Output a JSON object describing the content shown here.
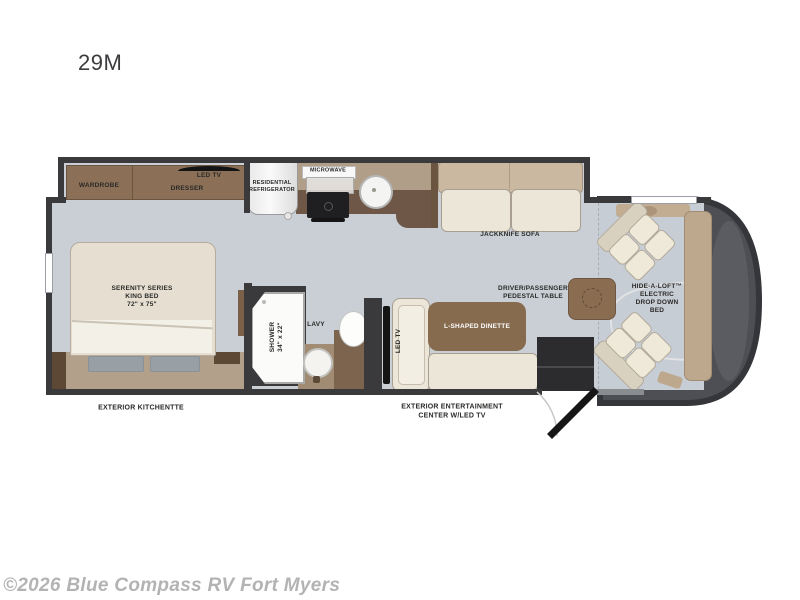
{
  "page": {
    "model": "29M",
    "watermark": "©2026 Blue Compass RV Fort Myers"
  },
  "colors": {
    "floor": "#c9cfd5",
    "wall": "#3a3a3c",
    "cabinet_wood": "#8b7057",
    "counter_dark": "#6e5746",
    "counter_light": "#b19e89",
    "seat_cream": "#ece6d8",
    "sofa_back_tan": "#cbb8a1",
    "cab_nose_gray": "#4e4f54",
    "bed_platform_tan": "#b2a08b"
  },
  "labels": {
    "wardrobe": "WARDROBE",
    "bedroom_tv": "LED TV",
    "dresser": "DRESSER",
    "refrigerator": "RESIDENTIAL\nREFRIGERATOR",
    "microwave": "MICROWAVE",
    "jackknife_sofa": "JACKKNIFE SOFA",
    "king_bed": "SERENITY SERIES\nKING BED\n72\" x 75\"",
    "shower": "SHOWER\n34\" x 22\"",
    "lavy": "LAVY",
    "dinette_tv": "LED TV",
    "dinette": "L-SHAPED DINETTE",
    "pedestal_table": "DRIVER/PASSENGER\nPEDESTAL TABLE",
    "hide_a_loft": "HIDE-A-LOFT™\nELECTRIC\nDROP DOWN\nBED",
    "exterior_kitchenette": "EXTERIOR KITCHENTTE",
    "exterior_entertainment": "EXTERIOR ENTERTAINMENT\nCENTER W/LED TV"
  }
}
